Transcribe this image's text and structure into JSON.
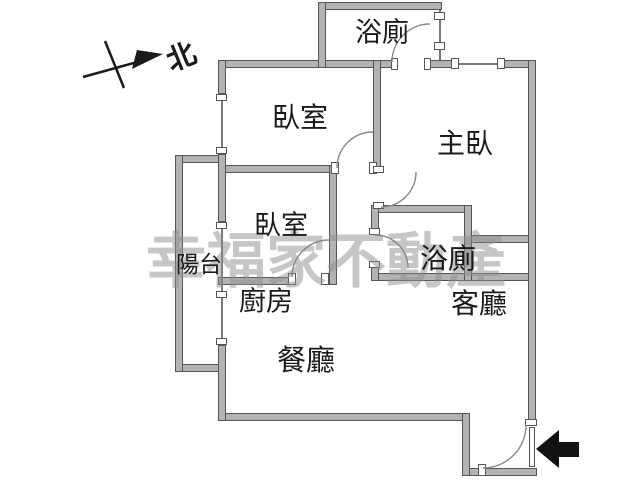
{
  "plan": {
    "title": "apartment-floor-plan",
    "watermark": "幸福家不動產",
    "north_label": "北",
    "rooms": [
      {
        "id": "bathroom-top",
        "label": "浴廁"
      },
      {
        "id": "bedroom-1",
        "label": "臥室"
      },
      {
        "id": "master-bedroom",
        "label": "主臥"
      },
      {
        "id": "bedroom-2",
        "label": "臥室"
      },
      {
        "id": "balcony",
        "label": "陽台"
      },
      {
        "id": "kitchen",
        "label": "廚房"
      },
      {
        "id": "bathroom-2",
        "label": "浴廁"
      },
      {
        "id": "living-room",
        "label": "客廳"
      },
      {
        "id": "dining-room",
        "label": "餐廳"
      }
    ],
    "colors": {
      "wall_fill": "#b3b3b3",
      "wall_stroke": "#555555",
      "background": "#ffffff",
      "label_text": "#1a1a1a",
      "watermark": "#8f8f8f",
      "entrance_arrow": "#111111"
    }
  }
}
